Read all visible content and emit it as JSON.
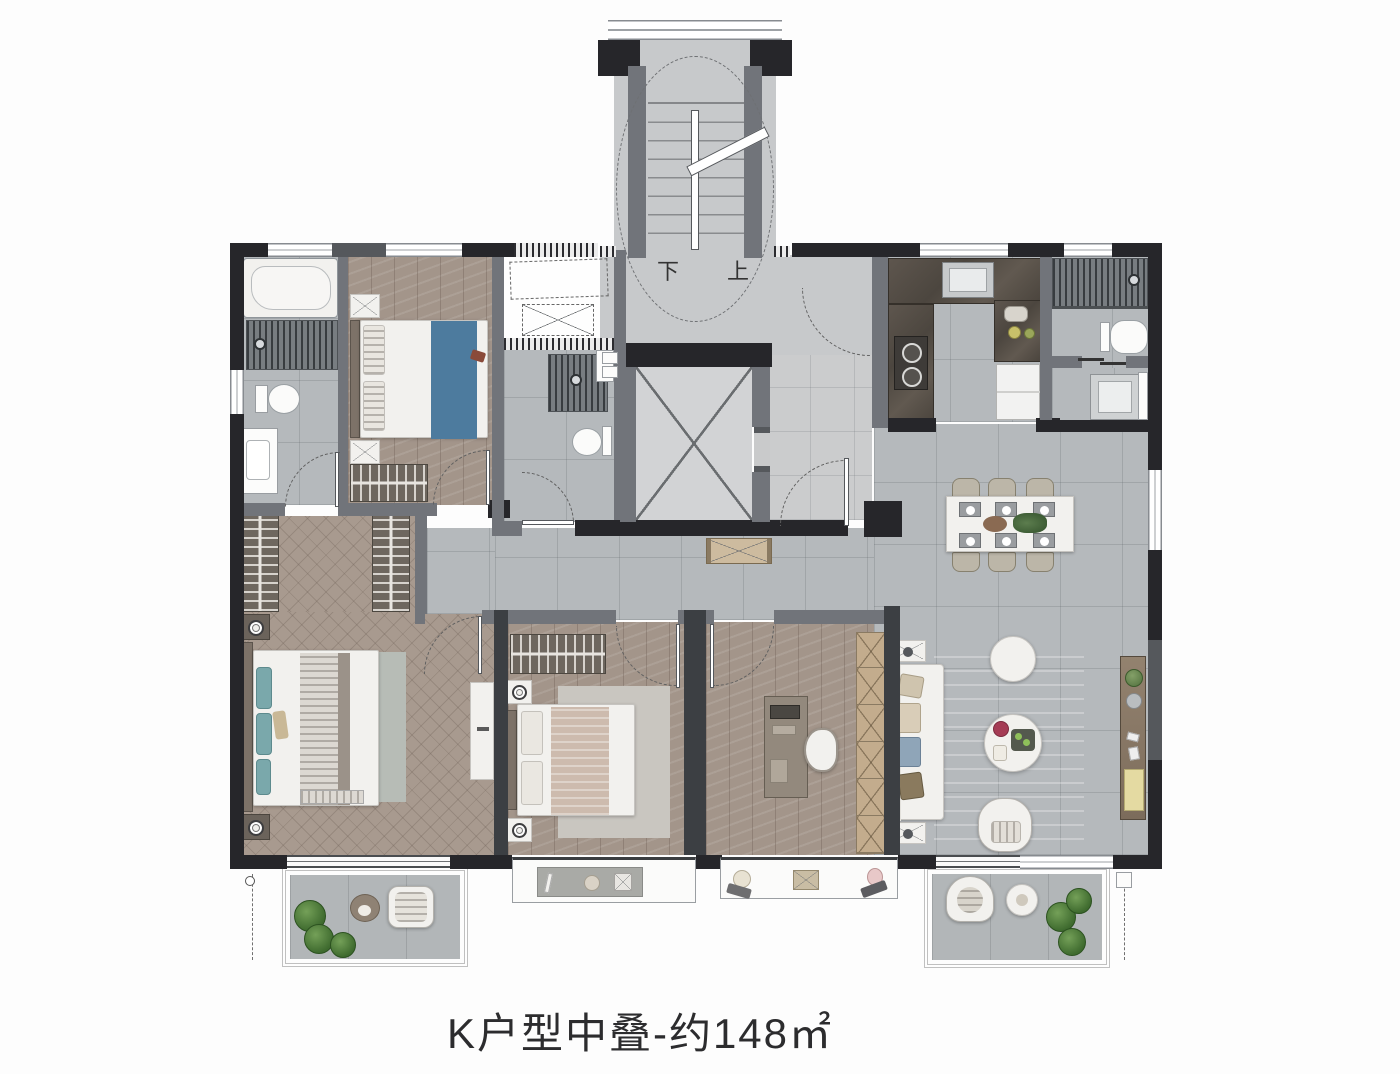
{
  "title": {
    "text": "K户型中叠-约148㎡"
  },
  "stairwell": {
    "down_label": "下",
    "up_label": "上"
  },
  "colors": {
    "wall_dark": "#26262a",
    "wall_gray": "#71747a",
    "wall_mid": "#55585c",
    "floor_tile": "#b5b9bc",
    "floor_tile_light": "#cbcccd",
    "stair_floor": "#c7c9cb",
    "wood_light": "#a3958a",
    "herringbone": "#a89a8f",
    "balcony_floor": "#b2b6b8",
    "rug_living": "#9fc0c8",
    "rug_bed2": "#c9c6c0",
    "rug_master": "#b7bcb6",
    "bed_runner_blue": "#4d7b9e",
    "teal_pillow": "#7aa8ab",
    "counter_dark": "#564f48",
    "wood_shelf": "#c3ac8d",
    "console_wood": "#8b7b6a",
    "accent_yellow": "#e4daa2",
    "plant_green": "#4e7a3c",
    "white_furn": "#f2f1ee"
  }
}
